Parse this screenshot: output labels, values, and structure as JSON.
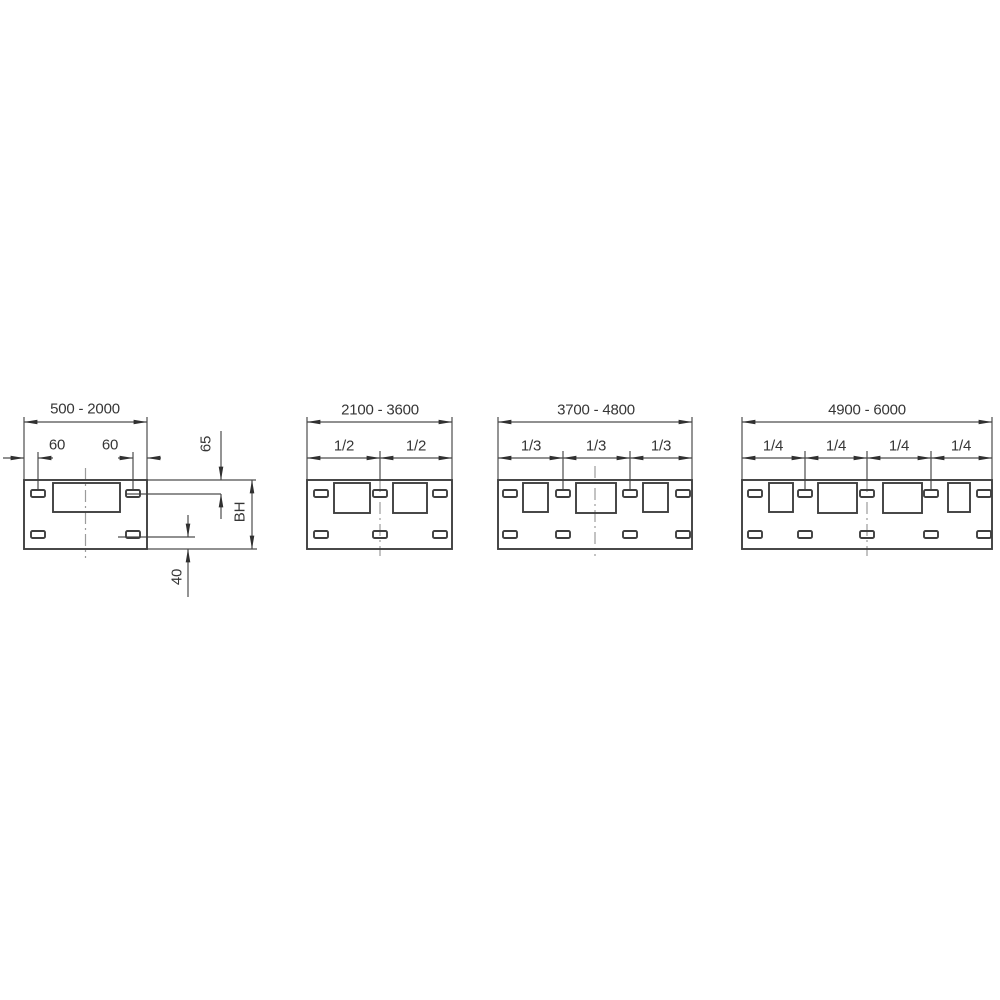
{
  "drawing_type": "panel-width-dimension-diagram",
  "panels": [
    {
      "range": "500 - 2000",
      "edge_offsets": [
        "60",
        "60"
      ],
      "side_dims": {
        "top_offset": "65",
        "body_height": "BH",
        "bottom_offset": "40"
      }
    },
    {
      "range": "2100 - 3600",
      "fractions": [
        "1/2",
        "1/2"
      ]
    },
    {
      "range": "3700 - 4800",
      "fractions": [
        "1/3",
        "1/3",
        "1/3"
      ]
    },
    {
      "range": "4900 - 6000",
      "fractions": [
        "1/4",
        "1/4",
        "1/4",
        "1/4"
      ]
    }
  ],
  "colors": {
    "background": "#ffffff",
    "feature_line": "#3f3f3f",
    "dimension_line": "#4d4d4d",
    "centerline": "#9b9b9b",
    "arrow": "#303030",
    "text": "#363636"
  }
}
